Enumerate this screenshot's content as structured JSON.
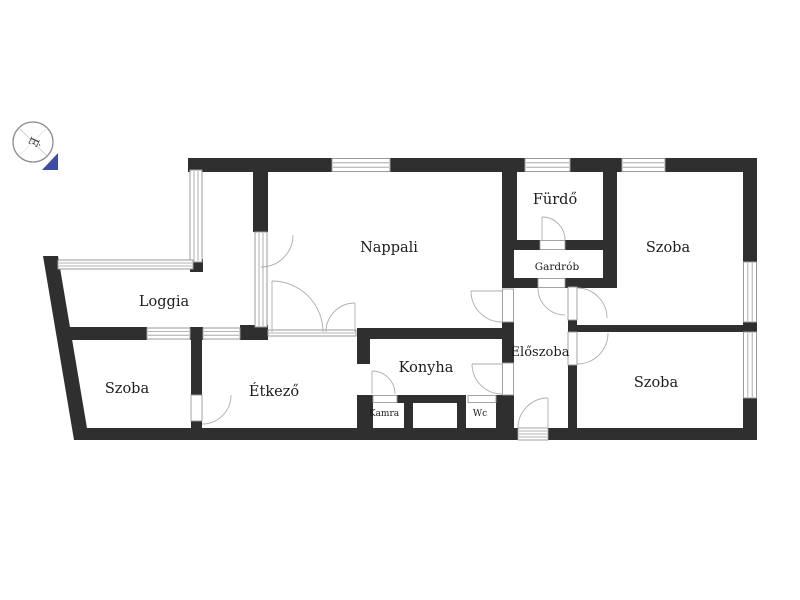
{
  "title": "Apartment floor plan",
  "compass": {
    "letter": "É",
    "needle_color": "#3e4da0"
  },
  "colors": {
    "wall": "#2f2f2f",
    "thin_line": "#9a9a9a",
    "label_text": "#1c1c1c"
  },
  "rooms": [
    {
      "id": "loggia",
      "label": "Loggia"
    },
    {
      "id": "szoba-bottom-left",
      "label": "Szoba"
    },
    {
      "id": "etkezo",
      "label": "Étkező"
    },
    {
      "id": "nappali",
      "label": "Nappali"
    },
    {
      "id": "konyha",
      "label": "Konyha"
    },
    {
      "id": "kamra",
      "label": "Kamra"
    },
    {
      "id": "wc",
      "label": "Wc"
    },
    {
      "id": "eloszoba",
      "label": "Előszoba"
    },
    {
      "id": "furdo",
      "label": "Fürdő"
    },
    {
      "id": "gardrob",
      "label": "Gardrób"
    },
    {
      "id": "szoba-top-right",
      "label": "Szoba"
    },
    {
      "id": "szoba-bottom-right",
      "label": "Szoba"
    }
  ]
}
